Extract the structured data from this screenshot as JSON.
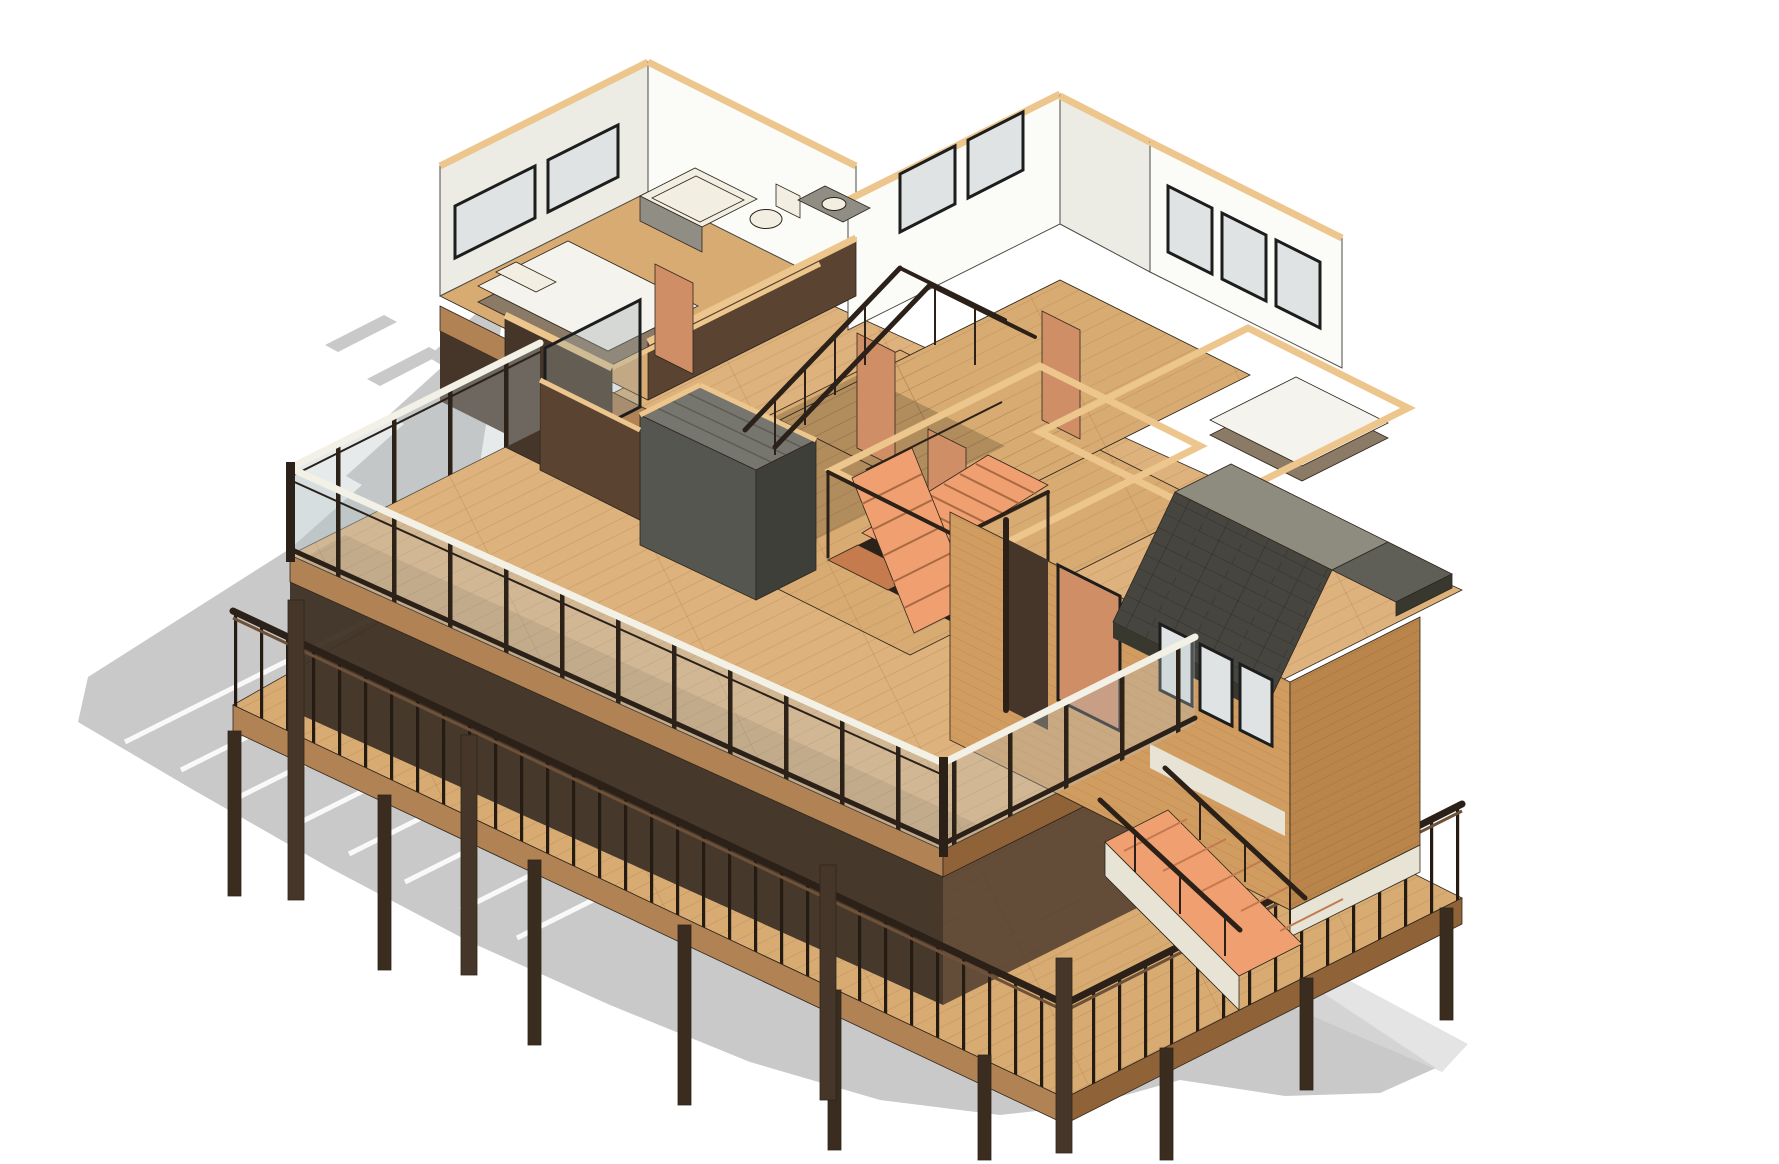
{
  "scene": {
    "description": "Isometric 3D cutaway rendering of a two-story wooden house model (BIM style): upper floor with bedrooms, bathroom and central switchback stair, wrap-around upper deck with glass guardrail, lower deck on posts with wood balustrade, gabled dormer wing at right, exterior stair at lower right, flat gray ground shadow cast to the lower left on a white background.",
    "view_type": "3d-isometric-render",
    "background": "#ffffff"
  },
  "colors": {
    "background": "#ffffff",
    "shadow": "#c9c9c9",
    "shadow_soft": "#d8d8d8",
    "white_stripe": "#ffffff",
    "deck_wood": "#deb27c",
    "floor_wood": "#d8ab72",
    "floor_wood_shaded": "#b68c5a",
    "fascia_wood": "#b08254",
    "fascia_dark": "#8f6238",
    "under_deck": "#3e3126",
    "frame_dark": "#3a2c1f",
    "railing_dark": "#2b2118",
    "rail_white": "#f3f1e6",
    "glass": "#b7c3c6",
    "glass_dark": "#6f7a76",
    "wall_white": "#fbfbf7",
    "wall_white_shade": "#ecece4",
    "wall_cap_tan": "#ecc68c",
    "cut_wall_brown": "#5a4331",
    "cut_wall_dark": "#46362a",
    "wood_wall_lit": "#d19c60",
    "wood_wall_shade": "#b9854b",
    "door_salmon": "#d08e66",
    "stair_orange": "#ef9f70",
    "stair_orange_deep": "#c57b4e",
    "closet_gray": "#565650",
    "closet_gray_top": "#76766e",
    "closet_gray_dark": "#3f3f3a",
    "roof_dark": "#46453f",
    "roof_ridge": "#8e8c7f",
    "roof_eave": "#605f57",
    "roof_fascia": "#39382f",
    "fixture_white": "#f2efe2",
    "fixture_gray": "#908e84",
    "mattress_white": "#f4f3ee",
    "bed_base": "#8b7a66",
    "window_frame": "#1d1d1d",
    "window_glass": "#dfe3e4",
    "sill_white": "#e7e4d6"
  },
  "parts": [
    {
      "name": "ground-shadow",
      "label": "cast shadow"
    },
    {
      "name": "lower-deck",
      "label": "lower deck on posts"
    },
    {
      "name": "upper-deck",
      "label": "upper wrap-around deck"
    },
    {
      "name": "glass-guardrail",
      "label": "glass deck guardrail"
    },
    {
      "name": "wood-balustrade",
      "label": "lower wood balustrade"
    },
    {
      "name": "bathroom",
      "label": "bathtub, toilet, vanity"
    },
    {
      "name": "bedroom-left",
      "label": "bedroom with double bed"
    },
    {
      "name": "bedroom-right",
      "label": "bedroom with double bed"
    },
    {
      "name": "interior-stair",
      "label": "switchback stair"
    },
    {
      "name": "dormer",
      "label": "gabled dormer wing"
    },
    {
      "name": "exterior-stair",
      "label": "deck access stair"
    },
    {
      "name": "doors",
      "label": "salmon wood doors"
    },
    {
      "name": "windows",
      "label": "dark framed windows"
    }
  ]
}
